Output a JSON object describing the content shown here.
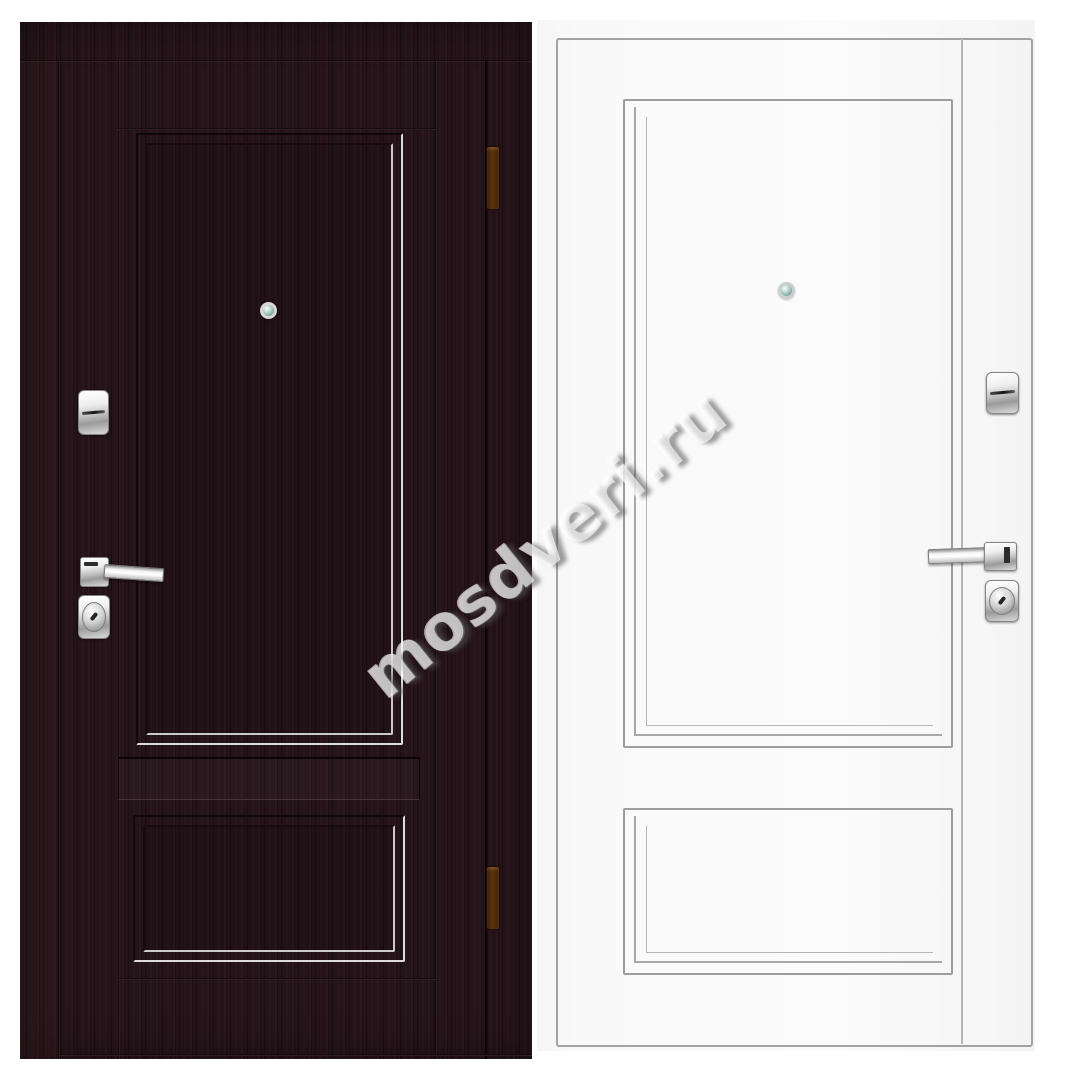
{
  "watermark": {
    "text": "mosdveri.ru"
  },
  "scene": {
    "type": "product-photo",
    "subject": "entry door shown from both sides, two leaves side by side",
    "left_door": {
      "finish": "dark wenge wood with frame",
      "panels": 2,
      "hinges": 2,
      "handle_side": "left",
      "hardware": [
        "lock-cover",
        "lever-handle",
        "keyhole-escutcheon",
        "peephole"
      ]
    },
    "right_door": {
      "finish": "white flat slab with applied moldings",
      "panels": 2,
      "hinges": 0,
      "handle_side": "right",
      "hardware": [
        "lock-cover",
        "lever-handle",
        "keyhole-escutcheon",
        "peephole"
      ]
    }
  },
  "colors": {
    "bg": "#ffffff",
    "dark-base": "#241419",
    "molding-highlight": "#dcdcdc",
    "white-base": "#f9f9f9",
    "white-line": "#a2a2a2",
    "chrome-light": "#efefef",
    "chrome-mid": "#c2c2c2",
    "chrome-dark": "#9a9a9a",
    "hinge-brown": "#5e3411",
    "lens-teal": "#a9cdc7"
  }
}
